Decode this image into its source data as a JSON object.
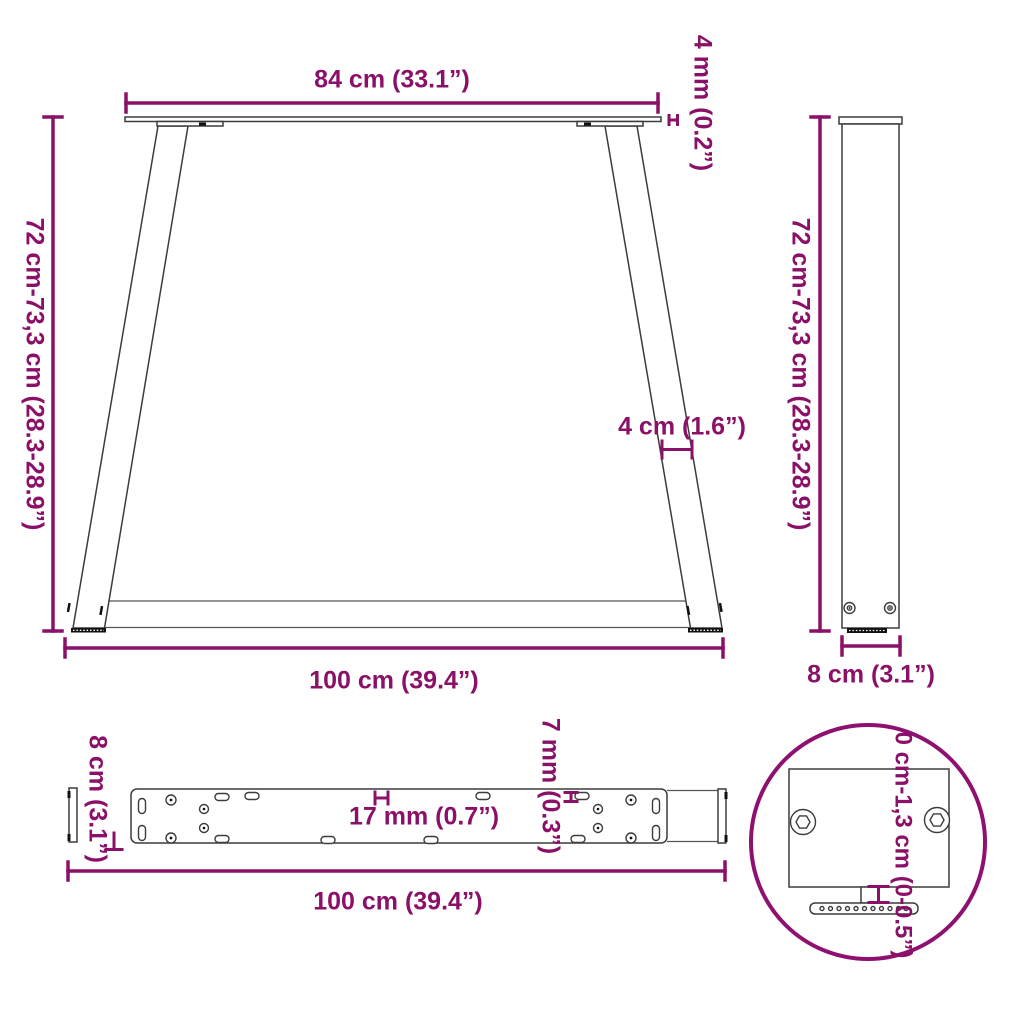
{
  "colors": {
    "dimension_accent": "#8A1068",
    "detail_circle_outline": "#8E1070",
    "drawing_outline": "#3c3c3c"
  },
  "front_view": {
    "top_width": "84 cm (33.1”)",
    "top_plate_thickness": "4 mm (0.2”)",
    "height_range": "72 cm-73,3 cm (28.3-28.9”)",
    "leg_profile_width": "4 cm (1.6”)",
    "bottom_width": "100 cm (39.4”)"
  },
  "side_view": {
    "height_range": "72 cm-73,3 cm (28.3-28.9”)",
    "depth": "8 cm (3.1”)"
  },
  "top_view": {
    "depth": "8 cm (3.1”)",
    "hole_spacing": "17 mm (0.7”)",
    "hole_offset": "7 mm (0.3”)",
    "length": "100 cm (39.4”)"
  },
  "detail_view": {
    "adjustment_range": "0 cm-1,3 cm (0-0.5”)"
  }
}
